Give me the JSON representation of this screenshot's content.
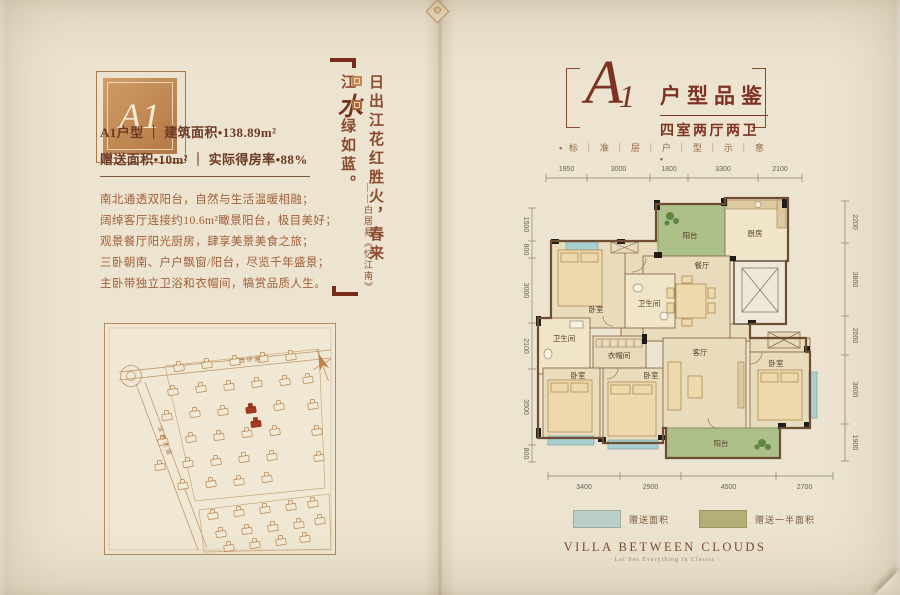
{
  "left_page": {
    "badge_label": "A1",
    "spec_line1": "A1户型 ｜ 建筑面积•138.89m²",
    "spec_line2": "赠送面积•10m²  ｜  实际得房率•88%",
    "features": [
      "南北通透双阳台，自然与生活温暖相融；",
      "阔绰客厅连接约10.6m²瞰景阳台，极目美好；",
      "观景餐厅阳光厨房，肆享美景美食之旅；",
      "三卧朝南、户户飘窗/阳台，尽览千年盛景；",
      "主卧带独立卫浴和衣帽间，犒赏品质人生。"
    ],
    "site_map": {
      "road_top": "西环路",
      "road_left": "滨水大道"
    }
  },
  "poem": {
    "text_before": "日出江花红胜火，春来江",
    "big_char": "水",
    "text_after": "绿如蓝。",
    "attribution": "——白居易《忆江南》"
  },
  "right_page": {
    "header": {
      "monogram": "A",
      "monogram_sub": "1",
      "title": "户型品鉴",
      "subtitle": "四室两厅两卫",
      "tagline": "▪ 标 ｜ 准 ｜ 层 ｜ 户 ｜ 型 ｜ 示 ｜ 意 ▪"
    },
    "floorplan": {
      "dims_top": [
        "1950",
        "3000",
        "1800",
        "3300",
        "2100"
      ],
      "dims_bottom": [
        "3400",
        "2900",
        "4500",
        "2700"
      ],
      "dims_left": [
        "1500",
        "800",
        "3000",
        "2100",
        "3500",
        "800"
      ],
      "dims_right": [
        "2200",
        "3800",
        "2000",
        "3600",
        "1900"
      ],
      "rooms": {
        "balcony_top": "阳台",
        "kitchen": "厨房",
        "dining": "餐厅",
        "bath": "卫生间",
        "bedroom": "卧室",
        "cloakroom": "衣帽间",
        "living": "客厅",
        "balcony_bottom": "阳台"
      }
    },
    "legend": {
      "items": [
        {
          "color": "#b9cfc7",
          "label": "赠送面积"
        },
        {
          "color": "#b4ae77",
          "label": "赠送一半面积"
        }
      ]
    },
    "footer": {
      "title": "VILLA BETWEEN CLOUDS",
      "tagline": "· Let See Everything In Classic ·"
    }
  }
}
